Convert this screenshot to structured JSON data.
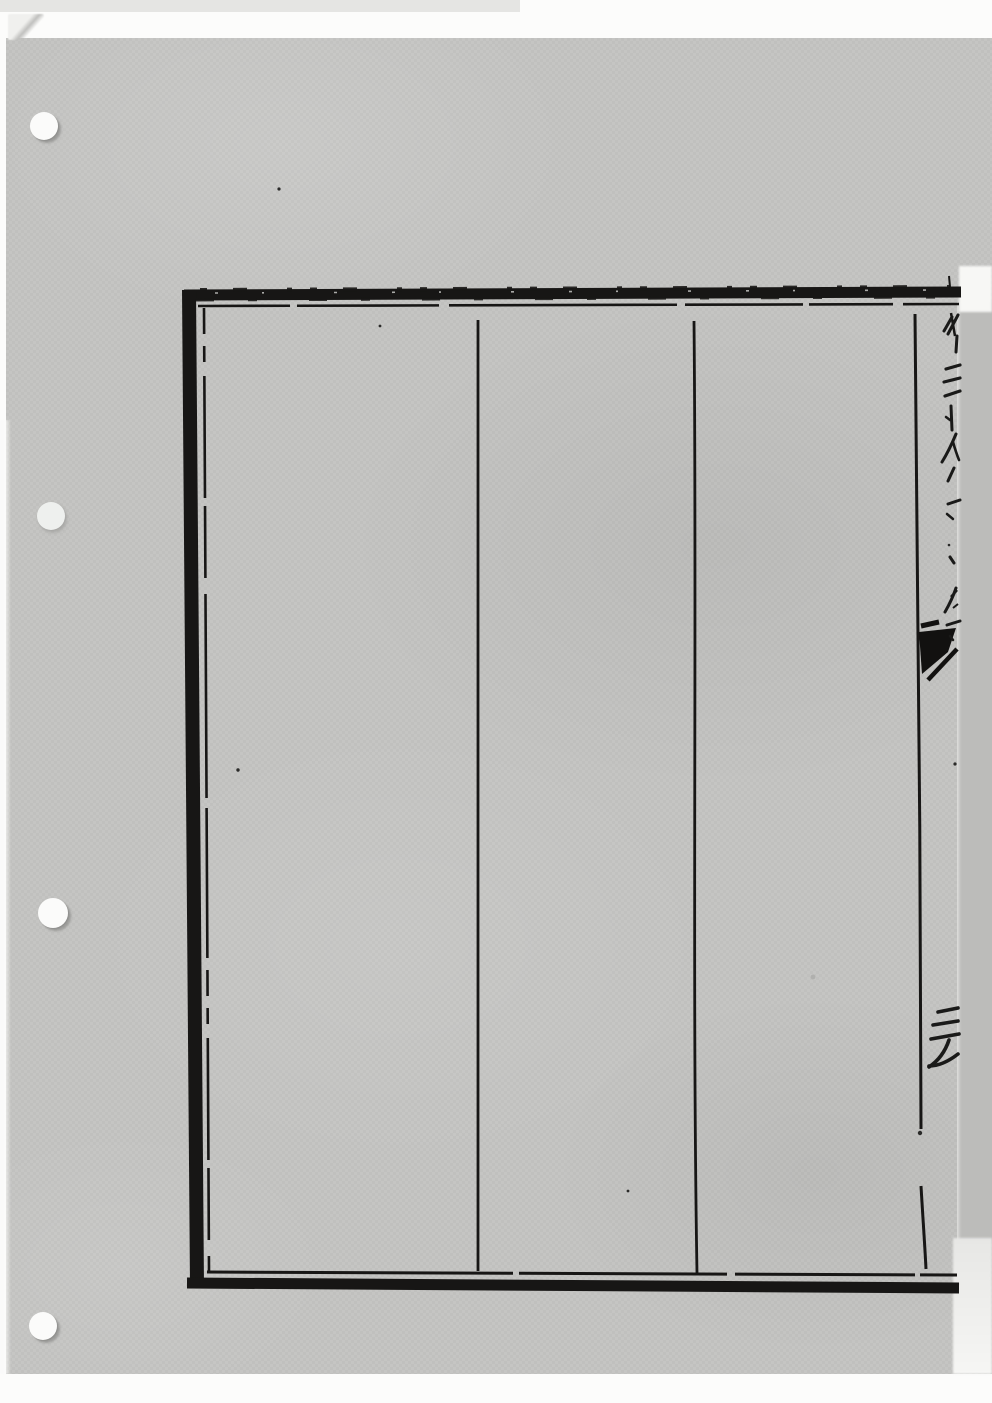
{
  "document": {
    "description": "Photocopy scan of a woodblock-printed East Asian book page: an empty ruled frame with vertical column lines; only clipped character fragments are visible along the right fold edge",
    "readable_text": "",
    "right_edge_glyph_fragments": [
      {
        "approx_glyph": "彳",
        "x": 943,
        "y": 314
      },
      {
        "approx_glyph": "三",
        "x": 944,
        "y": 362
      },
      {
        "approx_glyph": "卜",
        "x": 946,
        "y": 404
      },
      {
        "approx_glyph": "人",
        "x": 941,
        "y": 432
      },
      {
        "approx_glyph": "丶",
        "x": 946,
        "y": 466
      },
      {
        "approx_glyph": "一",
        "x": 944,
        "y": 498
      },
      {
        "approx_glyph": "丶",
        "x": 948,
        "y": 554
      },
      {
        "approx_glyph": "ノ",
        "x": 944,
        "y": 586
      },
      {
        "approx_glyph": "一",
        "x": 944,
        "y": 618
      },
      {
        "approx_glyph": "三天",
        "x": 927,
        "y": 1005
      }
    ]
  },
  "frame": {
    "outer": {
      "left": 183,
      "top": 287,
      "right": 961,
      "bottom": 1293
    },
    "inner_rule_inset": {
      "top": 306,
      "left": 206,
      "bottom": 1272
    },
    "column_lines_x": [
      478,
      695,
      917
    ],
    "columns_empty": true
  },
  "punch_holes": [
    {
      "cx": 44,
      "cy": 126,
      "r": 14,
      "faint": false
    },
    {
      "cx": 51,
      "cy": 516,
      "r": 14,
      "faint": true
    },
    {
      "cx": 53,
      "cy": 913,
      "r": 15,
      "faint": false
    },
    {
      "cx": 43,
      "cy": 1326,
      "r": 14,
      "faint": false
    }
  ],
  "colors": {
    "scanner_background": "#fcfcfb",
    "paper_gray": "#c5c5c3",
    "fold_strip_gray": "#bcbcba",
    "ink_black": "#171615",
    "hole_white": "#fbfbfa"
  }
}
